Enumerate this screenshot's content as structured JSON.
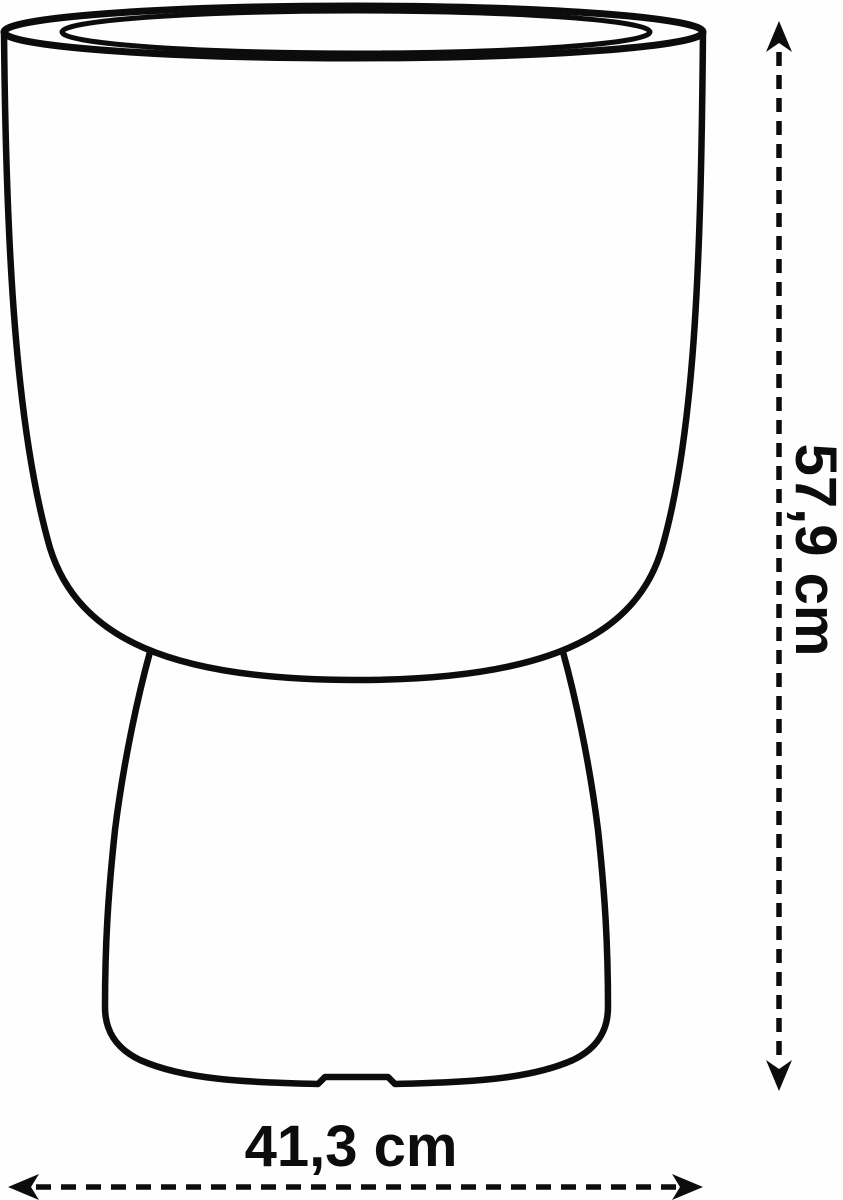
{
  "meta": {
    "background": "#fefefe",
    "line_color": "#0c0c0c"
  },
  "diagram": {
    "subject": "flower-pot-silhouette",
    "labels": {
      "height": "57,9 cm",
      "width": "41,3 cm"
    }
  }
}
